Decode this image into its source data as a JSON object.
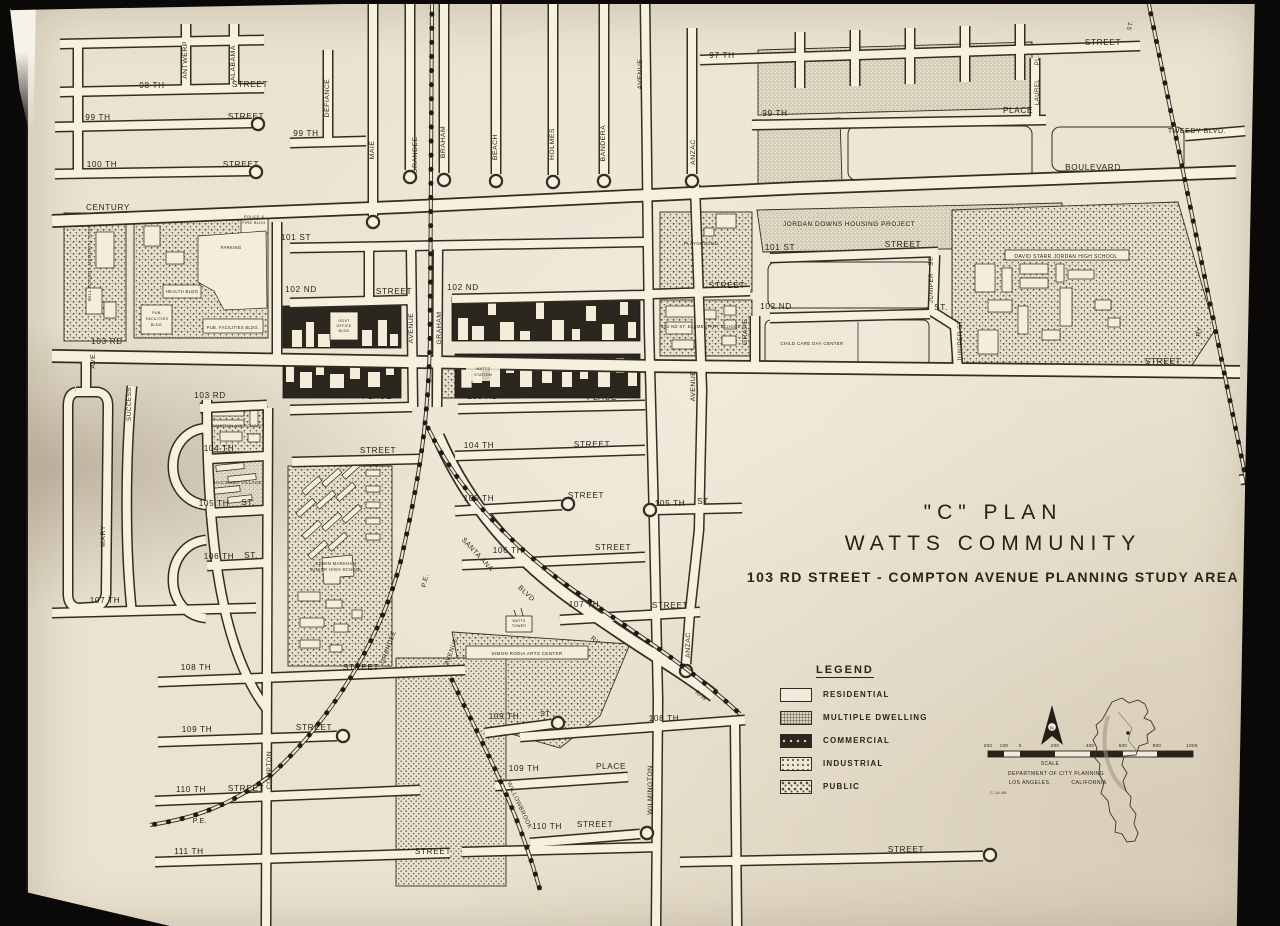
{
  "photo": {
    "backdrop_color": "#0a0908"
  },
  "page": {
    "paper_color": "#ebe3d0",
    "ink_color": "#2a2418",
    "street_fill": "#f6f0df"
  },
  "title": {
    "line1": "\"C\" PLAN",
    "line2": "WATTS COMMUNITY",
    "line3": "103 RD STREET - COMPTON AVENUE PLANNING STUDY AREA"
  },
  "legend": {
    "title": "LEGEND",
    "items": [
      {
        "label": "RESIDENTIAL",
        "pattern": "residential"
      },
      {
        "label": "MULTIPLE DWELLING",
        "pattern": "multiple"
      },
      {
        "label": "COMMERCIAL",
        "pattern": "commercial"
      },
      {
        "label": "INDUSTRIAL",
        "pattern": "industrial"
      },
      {
        "label": "PUBLIC",
        "pattern": "public"
      }
    ]
  },
  "scale_block": {
    "ticks": [
      "200",
      "100",
      "0",
      "200",
      "400",
      "600",
      "800",
      "1000"
    ],
    "label": "SCALE",
    "dept_line1": "DEPARTMENT OF CITY PLANNING",
    "dept_city": "LOS ANGELES,",
    "dept_state": "CALIFORNIA",
    "north": "N",
    "note": "C-14-65"
  },
  "map": {
    "labels": [
      {
        "t": "97 TH",
        "x": 722,
        "y": 58
      },
      {
        "t": "STREET",
        "x": 1103,
        "y": 45
      },
      {
        "t": "98 TH",
        "x": 152,
        "y": 88
      },
      {
        "t": "STREET",
        "x": 250,
        "y": 87
      },
      {
        "t": "99 TH",
        "x": 98,
        "y": 120
      },
      {
        "t": "STREET",
        "x": 246,
        "y": 119
      },
      {
        "t": "99 TH",
        "x": 306,
        "y": 136
      },
      {
        "t": "100 TH",
        "x": 102,
        "y": 167
      },
      {
        "t": "STREET",
        "x": 241,
        "y": 167
      },
      {
        "t": "CENTURY",
        "x": 108,
        "y": 210
      },
      {
        "t": "BOULEVARD",
        "x": 1093,
        "y": 170
      },
      {
        "t": "99 TH",
        "x": 775,
        "y": 116
      },
      {
        "t": "PLACE",
        "x": 1018,
        "y": 113
      },
      {
        "t": "TWEEDY BLVD.",
        "x": 1197,
        "y": 133,
        "s": 7
      },
      {
        "t": "101 ST",
        "x": 296,
        "y": 240
      },
      {
        "t": "101 ST",
        "x": 780,
        "y": 250
      },
      {
        "t": "STREET",
        "x": 903,
        "y": 247
      },
      {
        "t": "STREET",
        "x": 727,
        "y": 288
      },
      {
        "t": "102 ND",
        "x": 301,
        "y": 292
      },
      {
        "t": "STREET",
        "x": 394,
        "y": 294
      },
      {
        "t": "102 ND",
        "x": 463,
        "y": 290
      },
      {
        "t": "102 ND",
        "x": 776,
        "y": 309
      },
      {
        "t": "ST.",
        "x": 941,
        "y": 310
      },
      {
        "t": "103 RD",
        "x": 107,
        "y": 344
      },
      {
        "t": "STREET",
        "x": 1163,
        "y": 364
      },
      {
        "t": "103 RD",
        "x": 210,
        "y": 398
      },
      {
        "t": "PLACE",
        "x": 377,
        "y": 399
      },
      {
        "t": "103 RD",
        "x": 483,
        "y": 399
      },
      {
        "t": "PLACE",
        "x": 602,
        "y": 400
      },
      {
        "t": "104 TH",
        "x": 219,
        "y": 451
      },
      {
        "t": "STREET",
        "x": 378,
        "y": 453
      },
      {
        "t": "104 TH",
        "x": 479,
        "y": 448
      },
      {
        "t": "STREET",
        "x": 592,
        "y": 447
      },
      {
        "t": "105 TH",
        "x": 214,
        "y": 506
      },
      {
        "t": "ST.",
        "x": 248,
        "y": 505
      },
      {
        "t": "105 TH",
        "x": 479,
        "y": 501
      },
      {
        "t": "STREET",
        "x": 586,
        "y": 498
      },
      {
        "t": "105 TH",
        "x": 670,
        "y": 506
      },
      {
        "t": "ST.",
        "x": 704,
        "y": 504
      },
      {
        "t": "106 TH",
        "x": 219,
        "y": 559
      },
      {
        "t": "ST.",
        "x": 251,
        "y": 558
      },
      {
        "t": "106 TH",
        "x": 508,
        "y": 553
      },
      {
        "t": "STREET",
        "x": 613,
        "y": 550
      },
      {
        "t": "107 TH",
        "x": 105,
        "y": 603
      },
      {
        "t": "107 TH",
        "x": 584,
        "y": 607
      },
      {
        "t": "STREET",
        "x": 670,
        "y": 608
      },
      {
        "t": "108 TH",
        "x": 196,
        "y": 670
      },
      {
        "t": "STREET",
        "x": 361,
        "y": 670
      },
      {
        "t": "108 TH",
        "x": 664,
        "y": 721
      },
      {
        "t": "109 TH",
        "x": 197,
        "y": 732
      },
      {
        "t": "STREET",
        "x": 314,
        "y": 730
      },
      {
        "t": "109 TH",
        "x": 504,
        "y": 719
      },
      {
        "t": "ST",
        "x": 545,
        "y": 716,
        "s": 7
      },
      {
        "t": "109 TH",
        "x": 524,
        "y": 771
      },
      {
        "t": "PLACE",
        "x": 611,
        "y": 769
      },
      {
        "t": "110 TH",
        "x": 191,
        "y": 792
      },
      {
        "t": "STREET",
        "x": 246,
        "y": 791
      },
      {
        "t": "110 TH",
        "x": 547,
        "y": 829
      },
      {
        "t": "STREET",
        "x": 595,
        "y": 827
      },
      {
        "t": "111 TH",
        "x": 189,
        "y": 854
      },
      {
        "t": "STREET",
        "x": 433,
        "y": 854
      },
      {
        "t": "STREET",
        "x": 906,
        "y": 852
      },
      {
        "t": "P.E.",
        "x": 200,
        "y": 823,
        "s": 7
      },
      {
        "t": "ANTWERP",
        "x": 187,
        "y": 60,
        "r": -90,
        "s": 6.8
      },
      {
        "t": "ALABAMA",
        "x": 235,
        "y": 63,
        "r": -90,
        "s": 6.8
      },
      {
        "t": "DEFIANCE",
        "x": 329,
        "y": 98,
        "r": -90,
        "s": 6.8
      },
      {
        "t": "MAIE",
        "x": 374,
        "y": 150,
        "r": -90,
        "s": 6.8
      },
      {
        "t": "GRANDEE",
        "x": 417,
        "y": 155,
        "r": -90,
        "s": 6.8
      },
      {
        "t": "BRAHAM",
        "x": 445,
        "y": 142,
        "r": -90,
        "s": 6.8
      },
      {
        "t": "BEACH",
        "x": 497,
        "y": 147,
        "r": -90,
        "s": 6.8
      },
      {
        "t": "HOLMES",
        "x": 554,
        "y": 144,
        "r": -90,
        "s": 6.8
      },
      {
        "t": "BANDERA",
        "x": 605,
        "y": 143,
        "r": -90,
        "s": 6.8
      },
      {
        "t": "AVENUE",
        "x": 642,
        "y": 74,
        "r": -90,
        "s": 6.8
      },
      {
        "t": "ANZAC",
        "x": 695,
        "y": 152,
        "r": -90,
        "s": 6.8
      },
      {
        "t": "PL.",
        "x": 1039,
        "y": 60,
        "r": -90,
        "s": 6
      },
      {
        "t": "LAUREL",
        "x": 1039,
        "y": 92,
        "r": -90,
        "s": 6
      },
      {
        "t": "AVE.",
        "x": 95,
        "y": 360,
        "r": -90,
        "s": 6.8
      },
      {
        "t": "SUCCESS",
        "x": 131,
        "y": 404,
        "r": -90,
        "s": 6.3
      },
      {
        "t": "MARY",
        "x": 105,
        "y": 536,
        "r": -90,
        "s": 6.8
      },
      {
        "t": "AVENUE",
        "x": 413,
        "y": 328,
        "r": -90,
        "s": 6.8
      },
      {
        "t": "GRAHAM",
        "x": 441,
        "y": 328,
        "r": -90,
        "s": 6.8
      },
      {
        "t": "GRAPE",
        "x": 747,
        "y": 332,
        "r": -90,
        "s": 6.8
      },
      {
        "t": "ST.",
        "x": 933,
        "y": 261,
        "r": -90,
        "s": 6
      },
      {
        "t": "JUNIPER",
        "x": 933,
        "y": 288,
        "r": -90,
        "s": 6.3
      },
      {
        "t": "JUNIPER ST.",
        "x": 962,
        "y": 340,
        "r": -90,
        "s": 6.3
      },
      {
        "t": "AVENUE",
        "x": 695,
        "y": 386,
        "r": -90,
        "s": 6.8
      },
      {
        "t": "ANZAC",
        "x": 690,
        "y": 645,
        "r": -90,
        "s": 6.8
      },
      {
        "t": "WILMINGTON",
        "x": 652,
        "y": 790,
        "r": -90,
        "s": 6.8
      },
      {
        "t": "COMPTON",
        "x": 271,
        "y": 770,
        "r": -90,
        "s": 6.8
      },
      {
        "t": "WILL ROGERS MEMORIAL PARK",
        "x": 91,
        "y": 263,
        "r": -90,
        "s": 4.4
      },
      {
        "t": "RY",
        "x": 1201,
        "y": 332,
        "r": -80,
        "s": 6.5
      },
      {
        "t": "ST.",
        "x": 1132,
        "y": 26,
        "r": -75,
        "s": 6
      },
      {
        "t": "GRANDEE",
        "x": 390,
        "y": 648,
        "r": -70,
        "s": 6.3
      },
      {
        "t": "AVENUE",
        "x": 453,
        "y": 652,
        "r": -70,
        "s": 6.3
      },
      {
        "t": "P.E.",
        "x": 427,
        "y": 581,
        "r": -78,
        "s": 6.5
      },
      {
        "t": "SANTA ANA",
        "x": 476,
        "y": 556,
        "r": 47,
        "s": 7
      },
      {
        "t": "BLVD",
        "x": 525,
        "y": 595,
        "r": 44,
        "s": 7
      },
      {
        "t": "RY",
        "x": 594,
        "y": 642,
        "r": 40,
        "s": 6.5
      },
      {
        "t": "R/W",
        "x": 700,
        "y": 697,
        "r": 38,
        "s": 6
      },
      {
        "t": "WILLOWBROOK",
        "x": 518,
        "y": 806,
        "r": 65,
        "s": 6
      },
      {
        "t": "JORDAN DOWNS HOUSING PROJECT",
        "x": 849,
        "y": 226,
        "s": 6.5
      },
      {
        "t": "DAVID STARR JORDAN HIGH SCHOOL",
        "x": 1066,
        "y": 258,
        "s": 5
      },
      {
        "t": "PLAYGROUND",
        "x": 701,
        "y": 245,
        "s": 4.4
      },
      {
        "t": "102 ND ST. ELEMENTARY SCHOOL",
        "x": 701,
        "y": 328,
        "s": 4.2
      },
      {
        "t": "CHILD CARE DAY CENTER",
        "x": 812,
        "y": 345,
        "s": 4.4
      },
      {
        "t": "POLICE &",
        "x": 254,
        "y": 218,
        "s": 3.9
      },
      {
        "t": "FIRE BLDG",
        "x": 254,
        "y": 224,
        "s": 3.9
      },
      {
        "t": "PARKING",
        "x": 231,
        "y": 249,
        "s": 4.2
      },
      {
        "t": "HEALTH BLDG",
        "x": 182,
        "y": 293,
        "s": 4.2
      },
      {
        "t": "PUB.",
        "x": 157,
        "y": 314,
        "s": 3.7
      },
      {
        "t": "FACILITIES",
        "x": 157,
        "y": 320,
        "s": 3.7
      },
      {
        "t": "BLDG.",
        "x": 157,
        "y": 326,
        "s": 3.7
      },
      {
        "t": "PUB. FACILITIES BLDG.",
        "x": 233,
        "y": 329,
        "s": 4.1
      },
      {
        "t": "GOVT",
        "x": 344,
        "y": 322,
        "s": 3.6
      },
      {
        "t": "OFFICE",
        "x": 344,
        "y": 327,
        "s": 3.6
      },
      {
        "t": "BLDG",
        "x": 344,
        "y": 332,
        "s": 3.6
      },
      {
        "t": "WATTS",
        "x": 483,
        "y": 370,
        "s": 3.8
      },
      {
        "t": "STATION",
        "x": 483,
        "y": 376,
        "s": 3.8
      },
      {
        "t": "COMPTON AVE SCHOOL",
        "x": 237,
        "y": 427,
        "s": 3.9
      },
      {
        "t": "HACIENDA VILLAGE",
        "x": 238,
        "y": 484,
        "s": 4.4
      },
      {
        "t": "EDWIN MARKHAM",
        "x": 336,
        "y": 565,
        "s": 4.2
      },
      {
        "t": "JUNIOR HIGH SCHOOL",
        "x": 336,
        "y": 571,
        "s": 4.2
      },
      {
        "t": "WATTS",
        "x": 519,
        "y": 622,
        "s": 3.5
      },
      {
        "t": "TOWER",
        "x": 519,
        "y": 627,
        "s": 3.5
      },
      {
        "t": "SIMON RODIA ARTS CENTER",
        "x": 527,
        "y": 655,
        "s": 4.5
      },
      {
        "t": "SCALE",
        "x": 1050,
        "y": 765,
        "s": 5
      },
      {
        "t": "DEPARTMENT OF CITY PLANNING",
        "x": 1056,
        "y": 775,
        "s": 5.2
      },
      {
        "t": "LOS ANGELES,",
        "x": 1030,
        "y": 784,
        "s": 5.2
      },
      {
        "t": "CALIFORNIA",
        "x": 1089,
        "y": 784,
        "s": 5.2
      },
      {
        "t": "C-14-65",
        "x": 990,
        "y": 794,
        "s": 4,
        "a": "start"
      }
    ]
  }
}
